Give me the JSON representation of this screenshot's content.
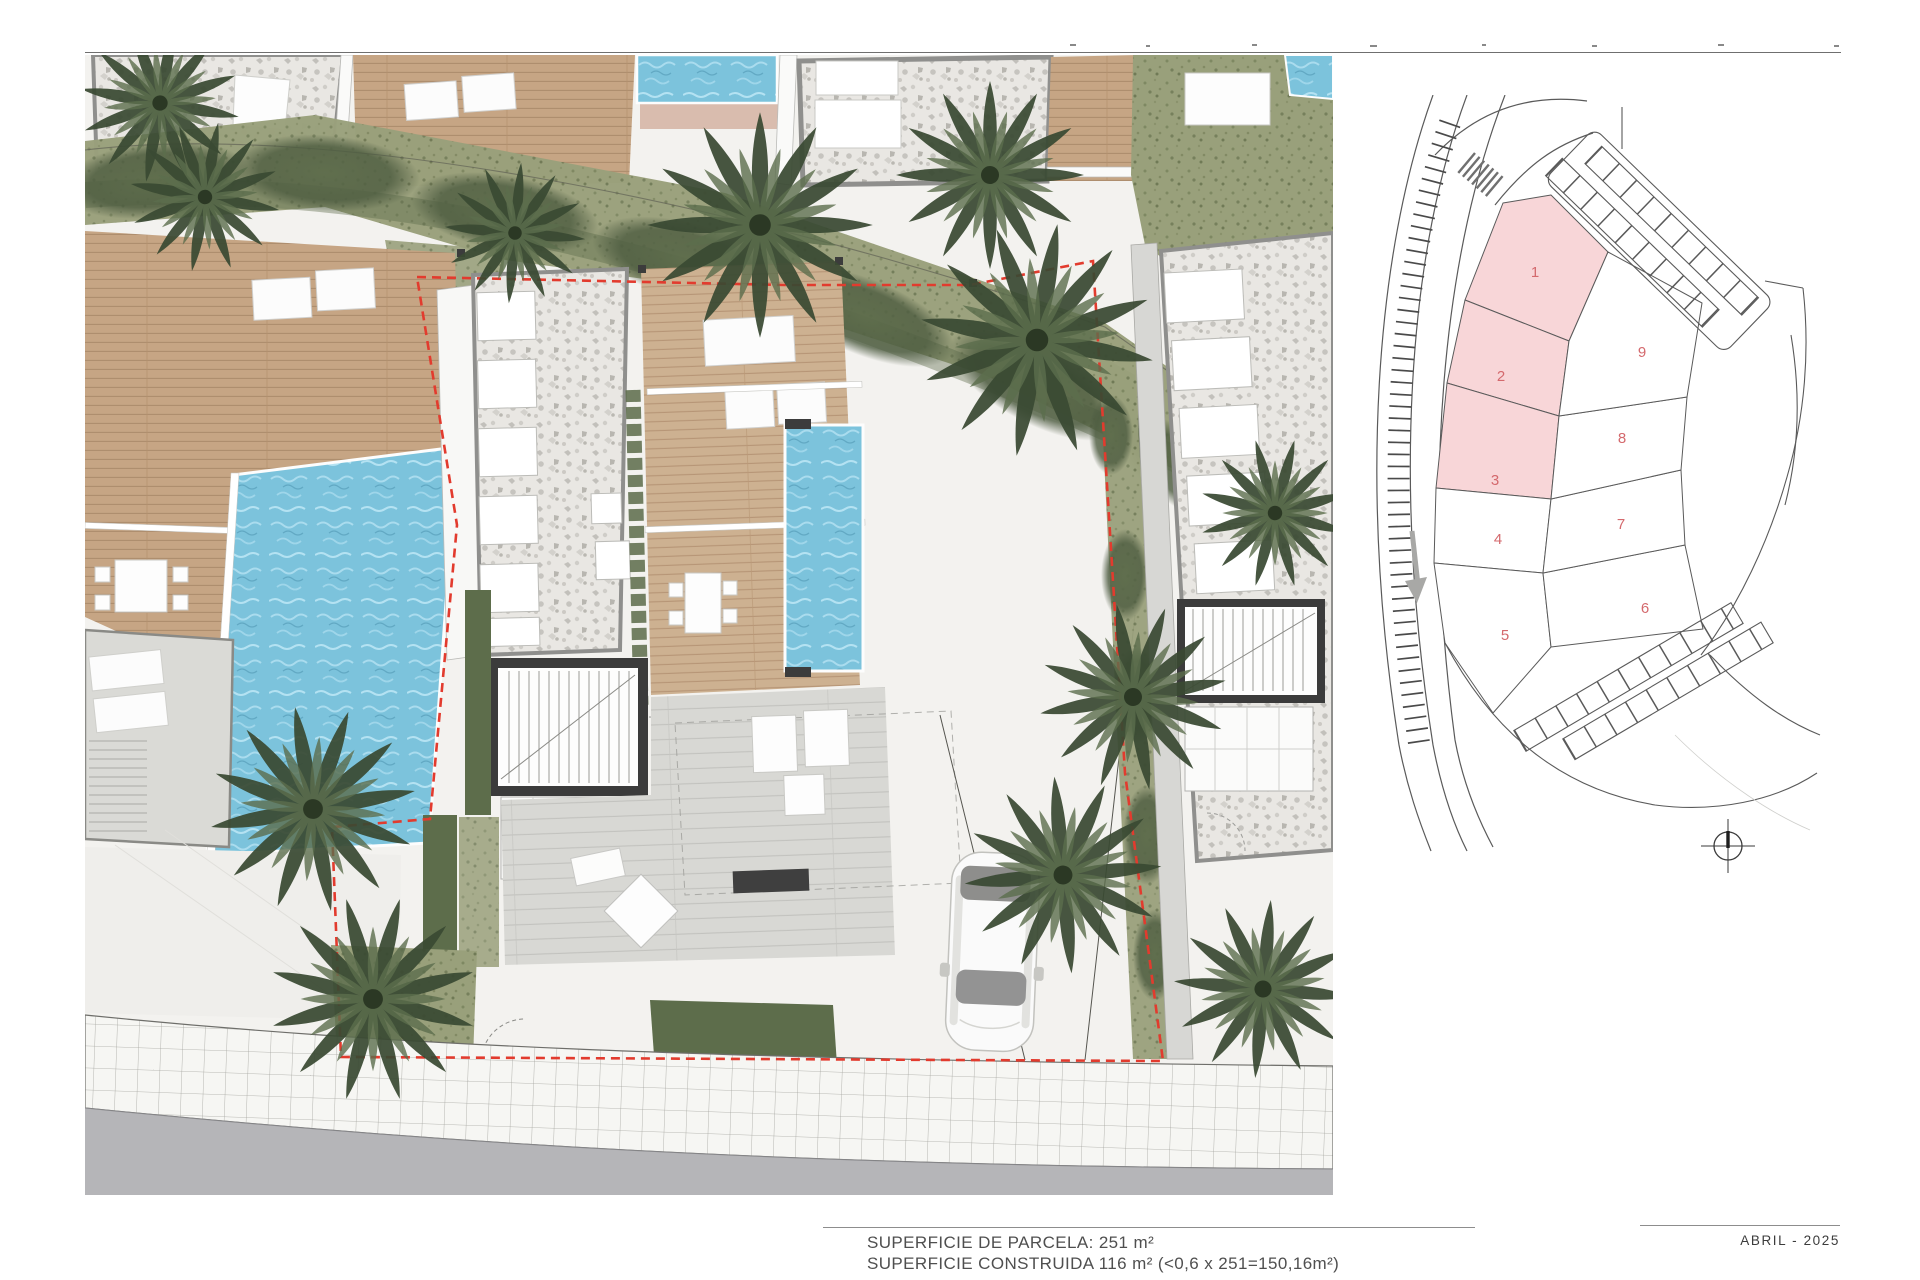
{
  "document": {
    "notes": {
      "line1": "SUPERFICIE DE PARCELA: 251 m²",
      "line2": "SUPERFICIE CONSTRUIDA 116 m² (<0,6 x 251=150,16m²)"
    },
    "date_label": "ABRIL - 2025"
  },
  "key_plan": {
    "highlight_fill": "#f8d6d8",
    "parcel_number_color": "#d4696d",
    "line_color": "#5a5a5a",
    "parcels": [
      {
        "number": "1",
        "highlighted": true
      },
      {
        "number": "2",
        "highlighted": true
      },
      {
        "number": "3",
        "highlighted": true
      },
      {
        "number": "4",
        "highlighted": false
      },
      {
        "number": "5",
        "highlighted": false
      },
      {
        "number": "6",
        "highlighted": false
      },
      {
        "number": "7",
        "highlighted": false
      },
      {
        "number": "8",
        "highlighted": false
      },
      {
        "number": "9",
        "highlighted": false
      }
    ]
  },
  "site_plan": {
    "boundary_color": "#e23b2e",
    "water_color": "#7cc3dc",
    "deck_color": "#c6a584",
    "gravel_color": "#e9e7e3",
    "vegetation_color": "#8c9272",
    "road_color": "#b5b5b8"
  }
}
